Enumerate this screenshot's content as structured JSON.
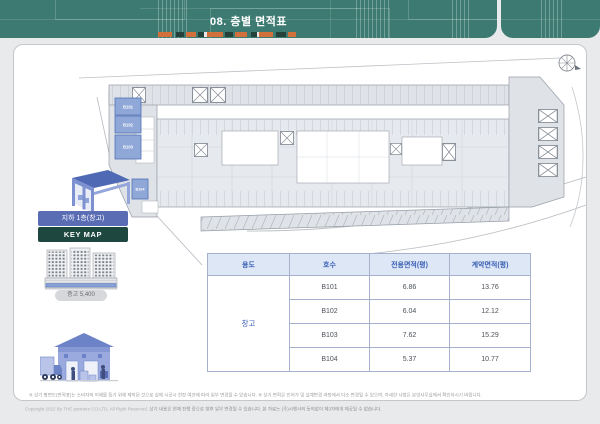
{
  "header": {
    "title": "08. 층별 면적표",
    "bg": "#3c7a72",
    "accent_orange": "#d2703c",
    "accent_dark": "#24423a"
  },
  "plan": {
    "units": [
      {
        "id": "B101"
      },
      {
        "id": "B102"
      },
      {
        "id": "B103"
      },
      {
        "id": "B104"
      }
    ],
    "unit_fill": "#8fa8d8",
    "unit_border": "#5272b4"
  },
  "keymap": {
    "floor_label": "지하 1층(창고)",
    "map_label": "KEY MAP",
    "floor_btn_bg": "#5a6cb4",
    "map_btn_bg": "#1d473f",
    "height_label": "층고 5,400"
  },
  "table": {
    "headers": [
      "용도",
      "호수",
      "전용면적(평)",
      "계약면적(평)"
    ],
    "usage_label": "창고",
    "rows": [
      {
        "unit": "B101",
        "exclusive": "6.86",
        "contract": "13.76"
      },
      {
        "unit": "B102",
        "exclusive": "6.04",
        "contract": "12.12"
      },
      {
        "unit": "B103",
        "exclusive": "7.62",
        "contract": "15.29"
      },
      {
        "unit": "B104",
        "exclusive": "5.37",
        "contract": "10.77"
      }
    ]
  },
  "footer": {
    "disclaimer": "※ 상기 평면도(면적표)는 소비자의 이해를 돕기 위해 제작된 것으로 실제 시공시 현장 여건에 따라 일부 변경될 수 있습니다. ※ 상기 면적은 인허가 및 설계변경 과정에서 다소 변경될 수 있으며, 자세한 사항은 분양사무실에서 확인하시기 바랍니다.",
    "copyright_en": "Copyright 2022 By THE partners CO.LTD. All Right Reserved.",
    "copyright_ko": "상기 내용은 현재 진행 중으로 향후 일부 변경될 수 있습니다. 본 자료는 (주)시행사의 동의없이 제3자에게 제공될 수 없습니다."
  }
}
